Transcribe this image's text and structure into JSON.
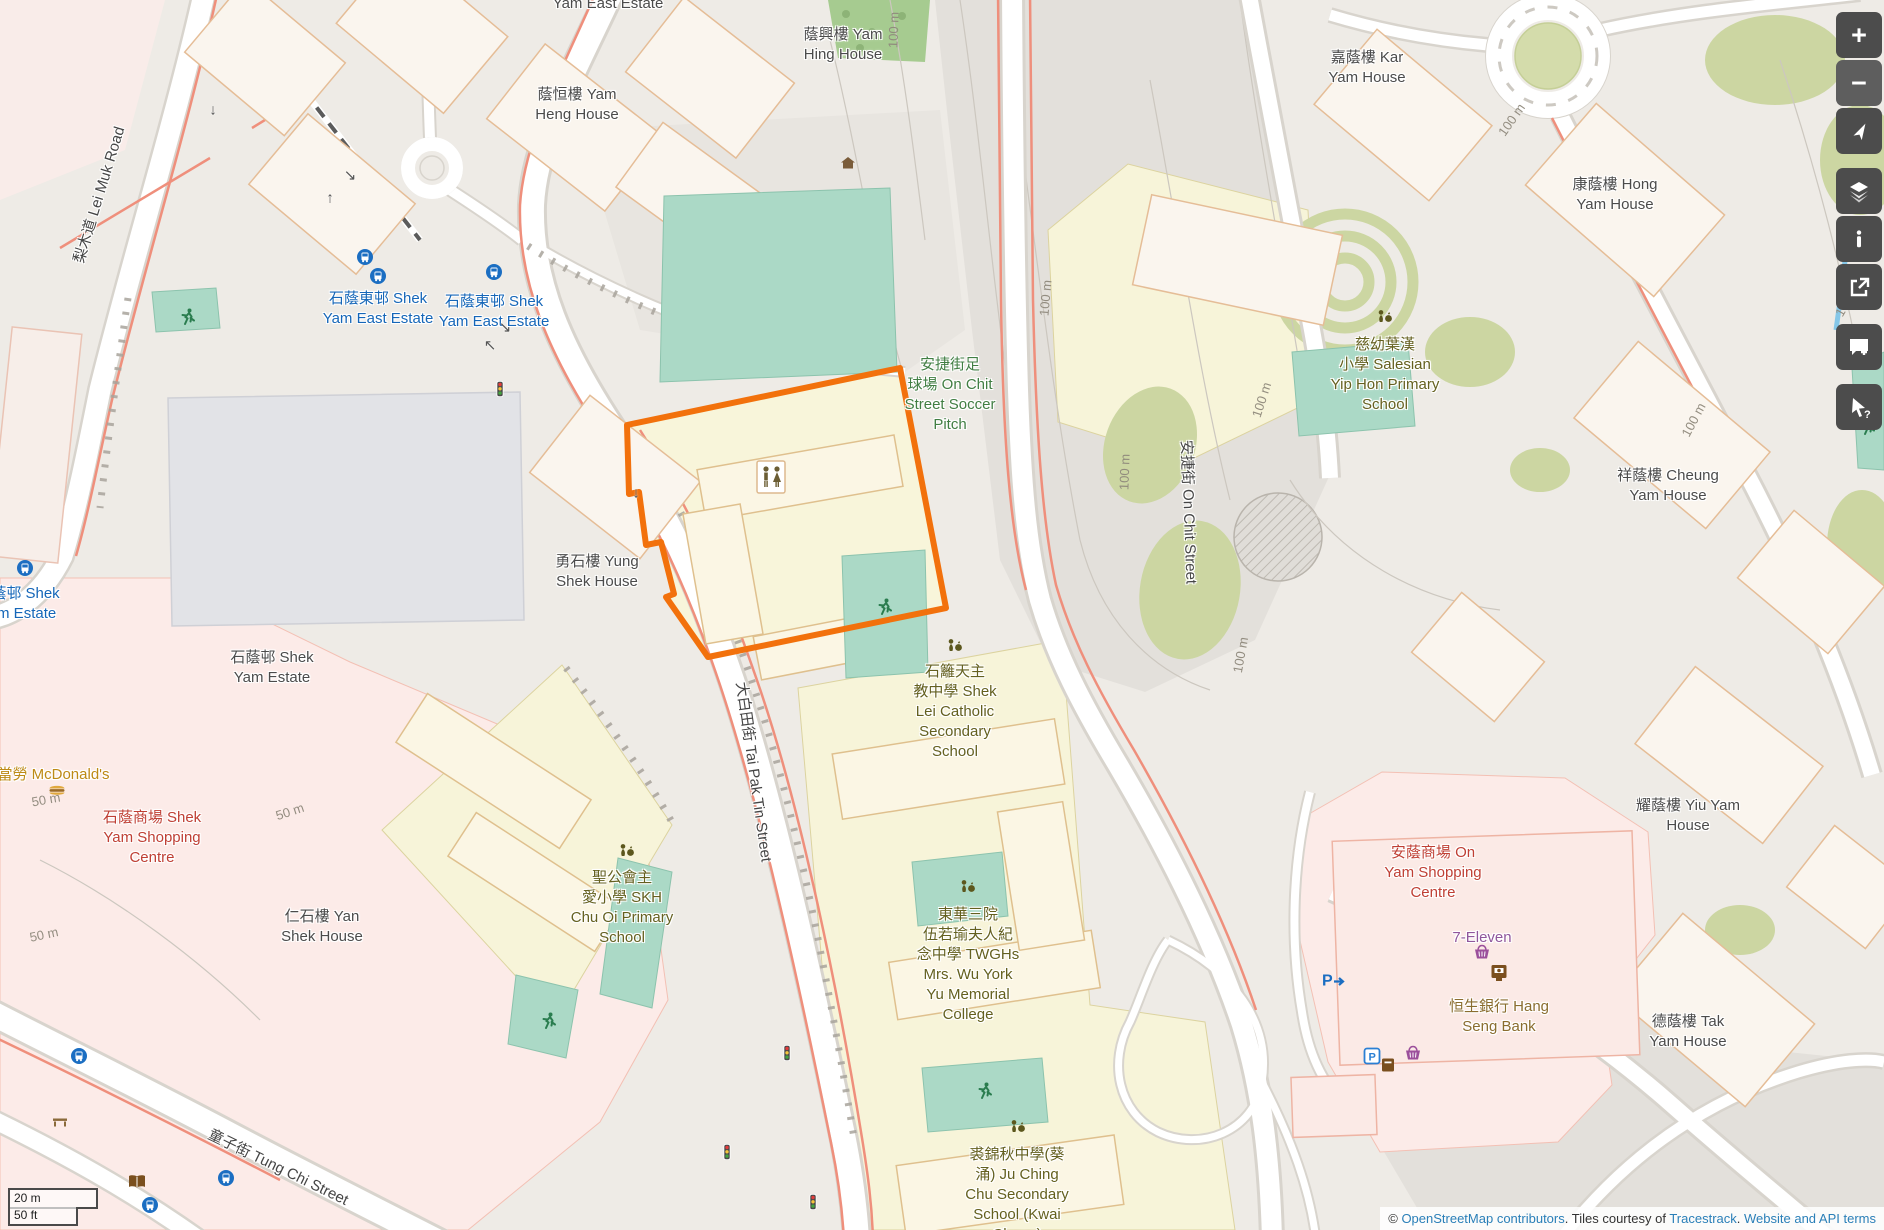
{
  "map": {
    "view": "OpenStreetMap",
    "highlight": {
      "name": "Shek Lei Catholic Secondary School parcel",
      "color": "#f2710c"
    },
    "label_colors": {
      "place": "#4b4b4b",
      "transit": "#1566b8",
      "school": "#64601f",
      "leisure": "#417e43",
      "retail": "#bf3f34",
      "shop": "#90579c",
      "amenity": "#8a6d2f",
      "fastfood": "#bd8a15",
      "road": "#454545",
      "contour": "#8f897c"
    },
    "labels": [
      {
        "id": "yam-east-estate-top",
        "cat": "place",
        "x": 608,
        "y": 4,
        "lines": [
          "Yam East Estate"
        ]
      },
      {
        "id": "yam-hing-house",
        "cat": "place",
        "x": 843,
        "y": 35,
        "lines": [
          "蔭興樓 Yam",
          "Hing House"
        ]
      },
      {
        "id": "yam-heng-house",
        "cat": "place",
        "x": 577,
        "y": 95,
        "lines": [
          "蔭恒樓 Yam",
          "Heng House"
        ]
      },
      {
        "id": "kar-yam-house",
        "cat": "place",
        "x": 1367,
        "y": 58,
        "lines": [
          "嘉蔭樓 Kar",
          "Yam House"
        ]
      },
      {
        "id": "hong-yam-house",
        "cat": "place",
        "x": 1615,
        "y": 185,
        "lines": [
          "康蔭樓 Hong",
          "Yam House"
        ]
      },
      {
        "id": "salesian-yip-hon",
        "cat": "school",
        "x": 1385,
        "y": 345,
        "lines": [
          "慈幼葉漢",
          "小學 Salesian",
          "Yip Hon Primary",
          "School"
        ]
      },
      {
        "id": "cheung-yam-house",
        "cat": "place",
        "x": 1668,
        "y": 476,
        "lines": [
          "祥蔭樓 Cheung",
          "Yam House"
        ]
      },
      {
        "id": "yung-shek-house",
        "cat": "place",
        "x": 597,
        "y": 562,
        "lines": [
          "勇石樓 Yung",
          "Shek House"
        ]
      },
      {
        "id": "shek-yam-estate",
        "cat": "place",
        "x": 272,
        "y": 658,
        "lines": [
          "石蔭邨 Shek",
          "Yam Estate"
        ]
      },
      {
        "id": "shek-yam-estate-stop",
        "cat": "transit",
        "x": 18,
        "y": 594,
        "lines": [
          "石蔭邨 Shek",
          "Yam Estate"
        ]
      },
      {
        "id": "shek-yam-east-stop-1",
        "cat": "transit",
        "x": 378,
        "y": 299,
        "lines": [
          "石蔭東邨 Shek",
          "Yam East Estate"
        ]
      },
      {
        "id": "shek-yam-east-stop-2",
        "cat": "transit",
        "x": 494,
        "y": 302,
        "lines": [
          "石蔭東邨 Shek",
          "Yam East Estate"
        ]
      },
      {
        "id": "soccer-pitch",
        "cat": "leisure",
        "x": 950,
        "y": 365,
        "lines": [
          "安捷街足",
          "球場 On Chit",
          "Street Soccer",
          "Pitch"
        ]
      },
      {
        "id": "shek-lei-catholic",
        "cat": "school",
        "x": 955,
        "y": 672,
        "lines": [
          "石籬天主",
          "教中學 Shek",
          "Lei Catholic",
          "Secondary",
          "School"
        ]
      },
      {
        "id": "mcdonalds",
        "cat": "fastfood",
        "x": 46,
        "y": 775,
        "lines": [
          "麥當勞 McDonald's"
        ]
      },
      {
        "id": "shek-yam-shopping-centre",
        "cat": "retail",
        "x": 152,
        "y": 818,
        "lines": [
          "石蔭商場 Shek",
          "Yam Shopping",
          "Centre"
        ]
      },
      {
        "id": "yan-shek-house",
        "cat": "place",
        "x": 322,
        "y": 917,
        "lines": [
          "仁石樓 Yan",
          "Shek House"
        ]
      },
      {
        "id": "skh-chu-oi",
        "cat": "school",
        "x": 622,
        "y": 878,
        "lines": [
          "聖公會主",
          "愛小學 SKH",
          "Chu Oi Primary",
          "School"
        ]
      },
      {
        "id": "twghs-college",
        "cat": "school",
        "x": 968,
        "y": 915,
        "lines": [
          "東華三院",
          "伍若瑜夫人紀",
          "念中學 TWGHs",
          "Mrs. Wu York",
          "Yu Memorial",
          "College"
        ]
      },
      {
        "id": "ju-ching-chu",
        "cat": "school",
        "x": 1017,
        "y": 1155,
        "lines": [
          "裘錦秋中學(葵",
          "涌) Ju Ching",
          "Chu Secondary",
          "School (Kwai",
          "Chung)"
        ]
      },
      {
        "id": "on-yam-shopping-centre",
        "cat": "retail",
        "x": 1433,
        "y": 853,
        "lines": [
          "安蔭商場 On",
          "Yam Shopping",
          "Centre"
        ]
      },
      {
        "id": "seven-eleven",
        "cat": "shop",
        "x": 1482,
        "y": 938,
        "lines": [
          "7-Eleven"
        ]
      },
      {
        "id": "hang-seng-bank",
        "cat": "amenity",
        "x": 1499,
        "y": 1007,
        "lines": [
          "恒生銀行 Hang",
          "Seng Bank"
        ]
      },
      {
        "id": "yiu-yam-house",
        "cat": "place",
        "x": 1688,
        "y": 806,
        "lines": [
          "耀蔭樓 Yiu Yam",
          "House"
        ]
      },
      {
        "id": "tak-yam-house",
        "cat": "place",
        "x": 1688,
        "y": 1022,
        "lines": [
          "德蔭樓 Tak",
          "Yam House"
        ]
      },
      {
        "id": "lei-muk-road",
        "cat": "road",
        "x": 100,
        "y": 195,
        "rot": -73,
        "lines": [
          "梨木道 Lei Muk Road"
        ]
      },
      {
        "id": "tai-pak-tin-street",
        "cat": "road",
        "x": 753,
        "y": 772,
        "rot": 82,
        "lines": [
          "大白田街 Tai Pak Tin Street"
        ]
      },
      {
        "id": "on-chit-street",
        "cat": "road",
        "x": 1188,
        "y": 512,
        "rot": 88,
        "lines": [
          "安捷街 On Chit Street"
        ]
      },
      {
        "id": "tung-chi-street",
        "cat": "road",
        "x": 278,
        "y": 1168,
        "rot": 26,
        "lines": [
          "童子街 Tung Chi Street"
        ]
      },
      {
        "id": "contour-100-a",
        "cat": "contour",
        "x": 894,
        "y": 30,
        "rot": -88,
        "lines": [
          "100 m"
        ]
      },
      {
        "id": "contour-100-b",
        "cat": "contour",
        "x": 1046,
        "y": 298,
        "rot": -85,
        "lines": [
          "100 m"
        ]
      },
      {
        "id": "contour-100-c",
        "cat": "contour",
        "x": 1125,
        "y": 472,
        "rot": -88,
        "lines": [
          "100 m"
        ]
      },
      {
        "id": "contour-100-d",
        "cat": "contour",
        "x": 1262,
        "y": 400,
        "rot": -72,
        "lines": [
          "100 m"
        ]
      },
      {
        "id": "contour-100-e",
        "cat": "contour",
        "x": 1512,
        "y": 120,
        "rot": -55,
        "lines": [
          "100 m"
        ]
      },
      {
        "id": "contour-100-f",
        "cat": "contour",
        "x": 1848,
        "y": 300,
        "rot": -60,
        "lines": [
          "100 m"
        ]
      },
      {
        "id": "contour-100-g",
        "cat": "contour",
        "x": 1241,
        "y": 655,
        "rot": -80,
        "lines": [
          "100 m"
        ]
      },
      {
        "id": "contour-100-h",
        "cat": "contour",
        "x": 1694,
        "y": 420,
        "rot": -62,
        "lines": [
          "100 m"
        ]
      },
      {
        "id": "contour-50-a",
        "cat": "contour",
        "x": 290,
        "y": 812,
        "rot": -18,
        "lines": [
          "50 m"
        ]
      },
      {
        "id": "contour-50-b",
        "cat": "contour",
        "x": 46,
        "y": 800,
        "rot": -10,
        "lines": [
          "50 m"
        ]
      },
      {
        "id": "contour-50-c",
        "cat": "contour",
        "x": 44,
        "y": 935,
        "rot": -12,
        "lines": [
          "50 m"
        ]
      }
    ],
    "pois": [
      {
        "type": "bus",
        "x": 365,
        "y": 257
      },
      {
        "type": "bus",
        "x": 378,
        "y": 276
      },
      {
        "type": "bus",
        "x": 494,
        "y": 272
      },
      {
        "type": "bus",
        "x": 25,
        "y": 568
      },
      {
        "type": "bus",
        "x": 79,
        "y": 1056
      },
      {
        "type": "bus",
        "x": 226,
        "y": 1178
      },
      {
        "type": "bus",
        "x": 150,
        "y": 1205
      },
      {
        "type": "runner",
        "x": 188,
        "y": 318
      },
      {
        "type": "runner",
        "x": 885,
        "y": 608
      },
      {
        "type": "runner",
        "x": 549,
        "y": 1022
      },
      {
        "type": "runner",
        "x": 985,
        "y": 1092
      },
      {
        "type": "runner",
        "x": 1868,
        "y": 428
      },
      {
        "type": "school",
        "x": 1385,
        "y": 318
      },
      {
        "type": "school",
        "x": 627,
        "y": 852
      },
      {
        "type": "school",
        "x": 968,
        "y": 888
      },
      {
        "type": "school",
        "x": 1018,
        "y": 1128
      },
      {
        "type": "school",
        "x": 955,
        "y": 647
      },
      {
        "type": "toilets",
        "x": 771,
        "y": 477
      },
      {
        "type": "home",
        "x": 848,
        "y": 163
      },
      {
        "type": "signal",
        "x": 500,
        "y": 389
      },
      {
        "type": "signal",
        "x": 787,
        "y": 1053
      },
      {
        "type": "signal",
        "x": 727,
        "y": 1152
      },
      {
        "type": "signal",
        "x": 813,
        "y": 1202
      },
      {
        "type": "parking_entrance",
        "x": 1335,
        "y": 980
      },
      {
        "type": "parking",
        "x": 1372,
        "y": 1056
      },
      {
        "type": "postbox",
        "x": 1388,
        "y": 1065
      },
      {
        "type": "basket",
        "x": 1482,
        "y": 952
      },
      {
        "type": "basket",
        "x": 1413,
        "y": 1053
      },
      {
        "type": "atm",
        "x": 1499,
        "y": 973
      },
      {
        "type": "burger",
        "x": 57,
        "y": 790
      },
      {
        "type": "book",
        "x": 137,
        "y": 1182
      },
      {
        "type": "bench",
        "x": 60,
        "y": 1122
      },
      {
        "type": "arrow",
        "x": 213,
        "y": 110,
        "glyph": "↓"
      },
      {
        "type": "arrow",
        "x": 350,
        "y": 175,
        "glyph": "↘"
      },
      {
        "type": "arrow",
        "x": 330,
        "y": 198,
        "glyph": "↑"
      },
      {
        "type": "arrow",
        "x": 505,
        "y": 327,
        "glyph": "↘"
      },
      {
        "type": "arrow",
        "x": 490,
        "y": 345,
        "glyph": "↖"
      },
      {
        "type": "arrow",
        "x": 636,
        "y": 493,
        "glyph": "↓"
      }
    ],
    "controls": {
      "zoom_in_label": "+",
      "zoom_out_label": "−"
    },
    "scale_bar": {
      "metric": "20 m",
      "imperial": "50 ft"
    },
    "attribution": {
      "copyright_symbol": "©",
      "osm_link": "OpenStreetMap contributors",
      "dot1": ".",
      "tiles_notice": "Tiles courtesy of",
      "tiles_provider": "Tracestrack",
      "dot2": ".",
      "terms_link": "Website and API terms"
    }
  }
}
